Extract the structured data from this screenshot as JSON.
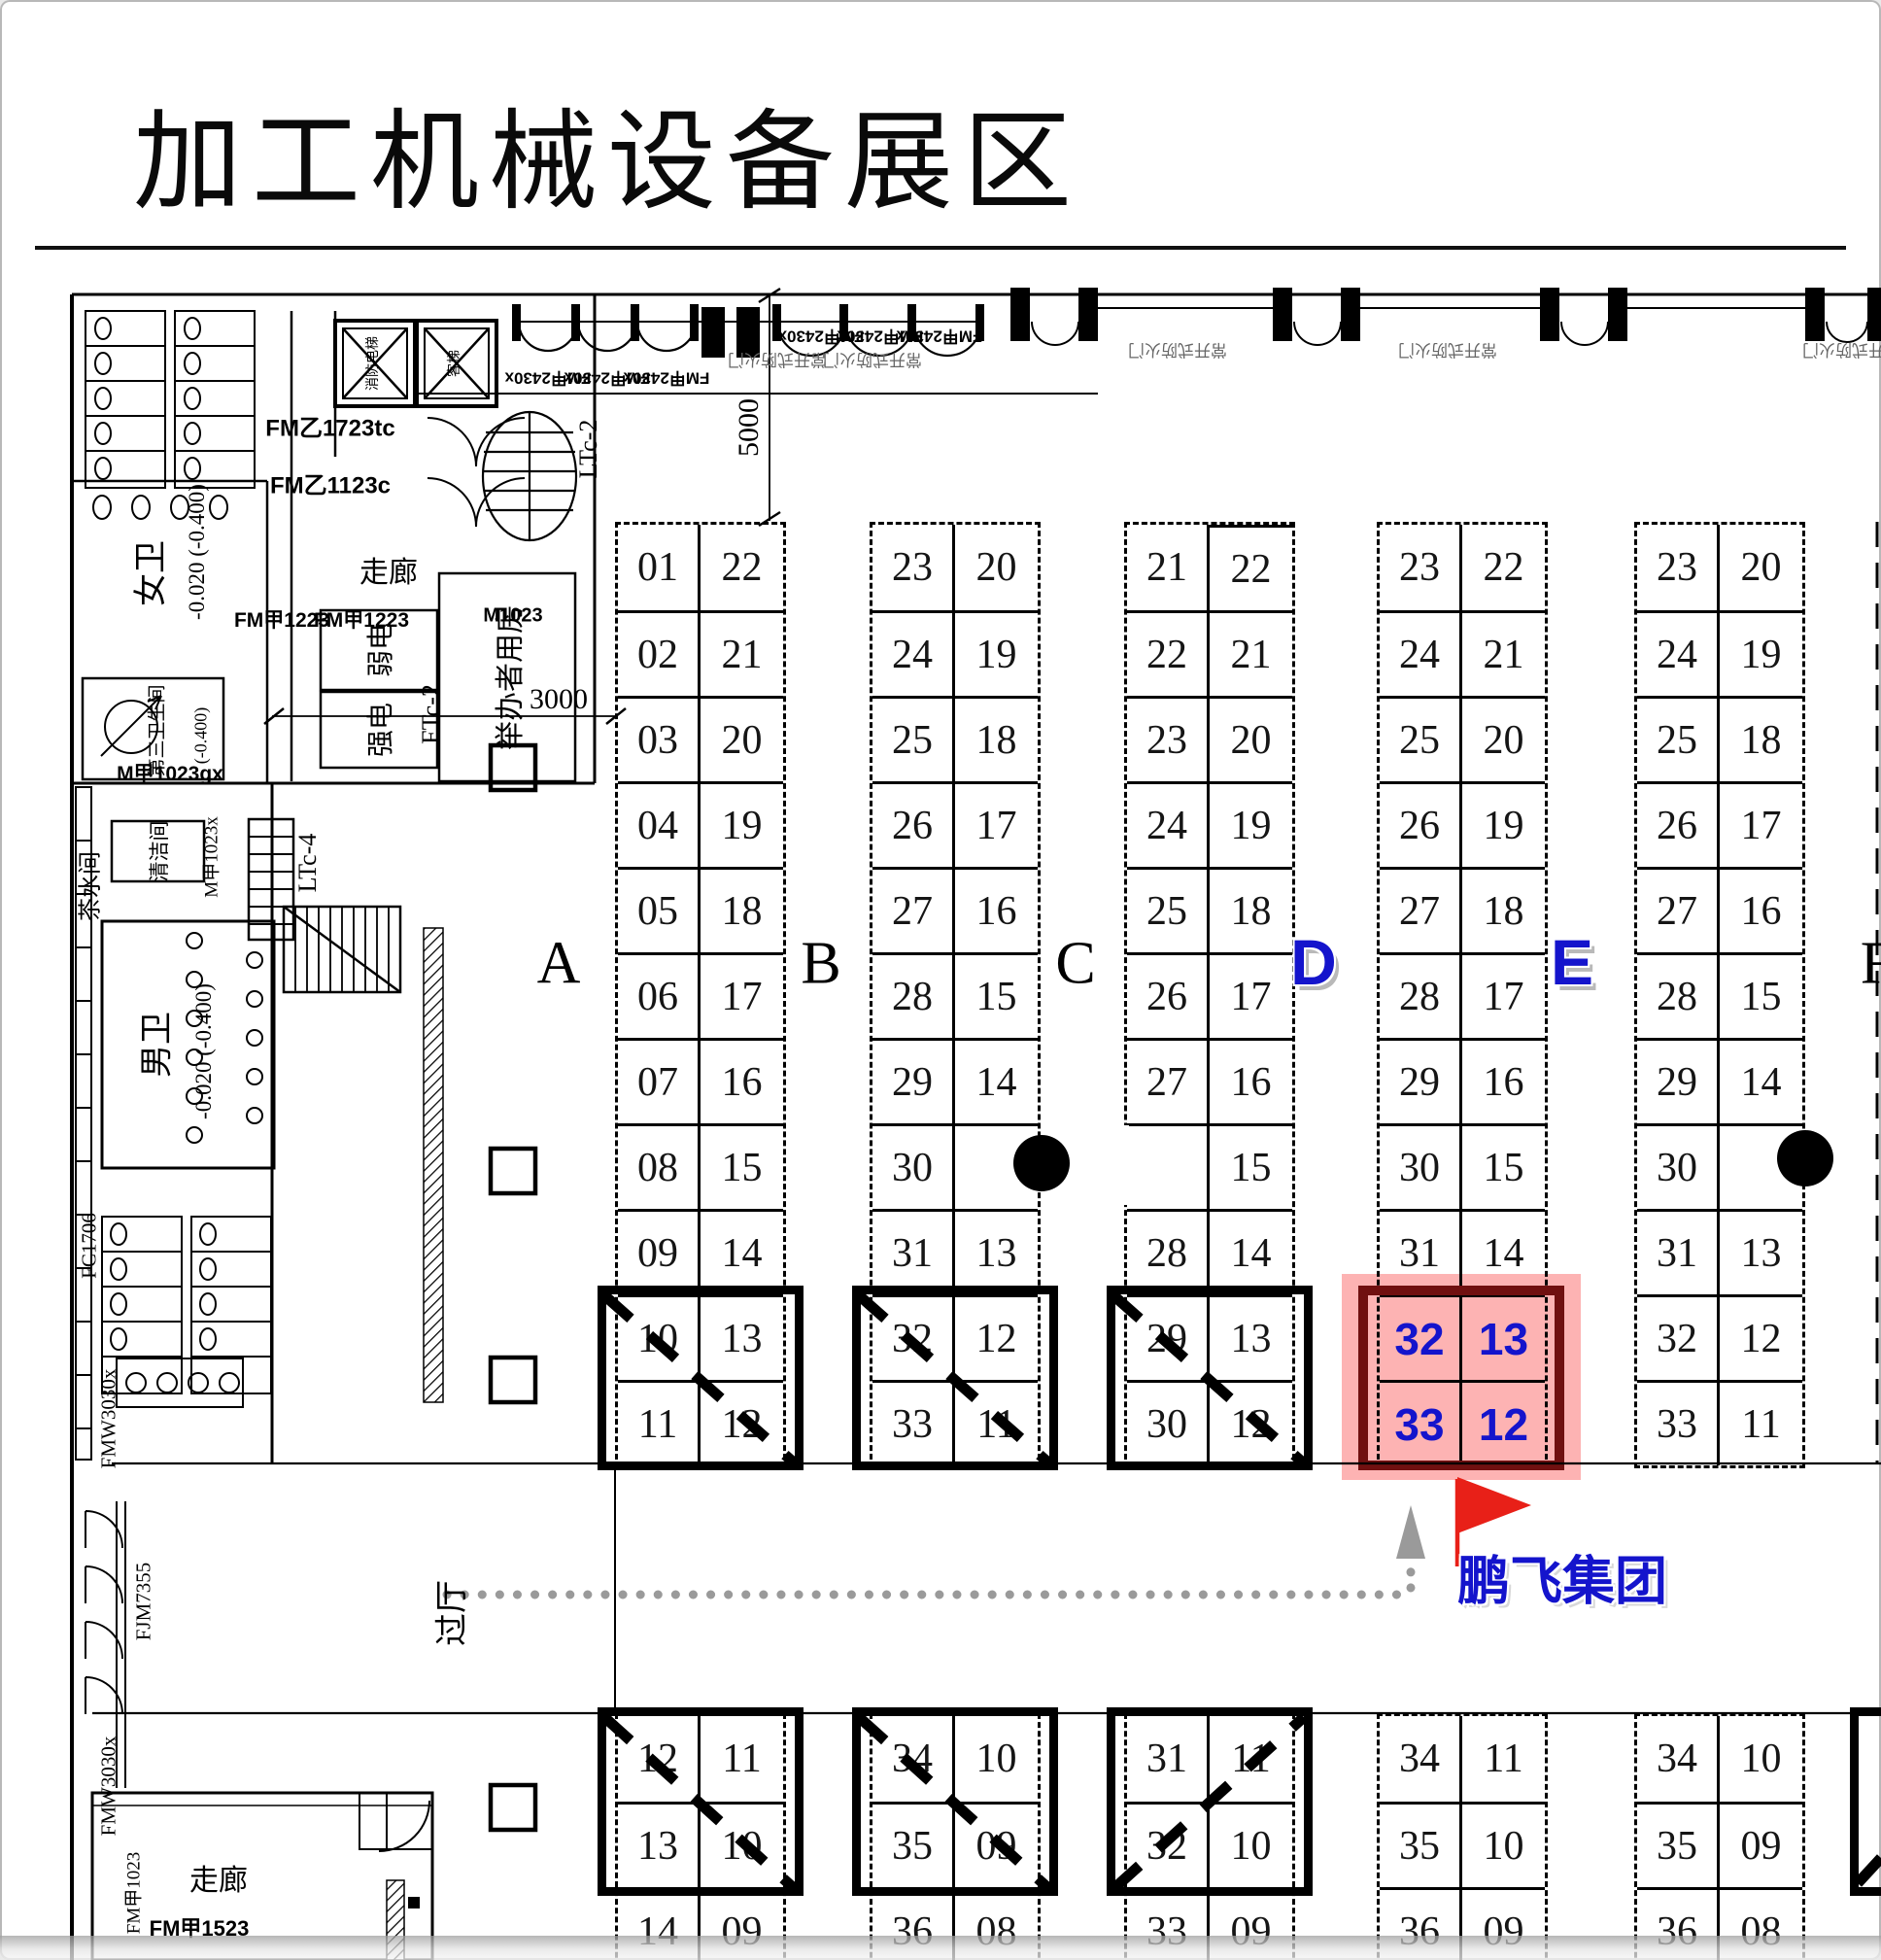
{
  "title": "加工机械设备展区",
  "zones": {
    "a": "A",
    "b": "B",
    "c": "C",
    "d": "D",
    "e": "E",
    "f": "F"
  },
  "dims": {
    "d5000": "5000",
    "d3000": "3000"
  },
  "band": {
    "door_tag": "FM甲2430x",
    "fire_door": "常开式防火门"
  },
  "marker": {
    "company": "鹏飞集团"
  },
  "colors": {
    "highlight_fill": "#fa6060",
    "highlight_border": "#701010",
    "accent_blue": "#1414cc",
    "flag_red": "#e82018",
    "route_gray": "#9a9a9a"
  },
  "plan": {
    "women_wc": "女卫",
    "women_level": "-0.020 (-0.400)",
    "third_wc": "第三卫生间",
    "third_level": "(-0.400)",
    "men_wc": "男卫",
    "men_level": "-0.020 (-0.400)",
    "corridor_mid": "走廊",
    "corridor_bottom": "走廊",
    "weak_electric": "弱电",
    "strong_electric": "强电",
    "organizer_room": "举办者用房",
    "tea_room": "茶水间",
    "cleaning_room": "清洁间",
    "lobby": "过厅",
    "fire_elevator": "消防电梯",
    "passenger_elevator": "客梯",
    "lt2": "LTc-2",
    "lt4": "LTc-4",
    "ft2": "FTc-2",
    "fm1723": "FM乙1723tc",
    "fm1123": "FM乙1123c",
    "fm1223": "FM甲1223",
    "m1023": "M1023",
    "m1023gx": "M甲1023gx",
    "m1023x": "M甲1023x",
    "fm1523": "FM甲1523",
    "fm1023": "FM甲1023",
    "fmw3030": "FMW3030x",
    "fjm7355": "FJM7355",
    "fc1706": "FC1706"
  },
  "blocks_top": [
    {
      "zone": "A",
      "cells": [
        [
          "01",
          "22"
        ],
        [
          "02",
          "21"
        ],
        [
          "03",
          "20"
        ],
        [
          "04",
          "19"
        ],
        [
          "05",
          "18"
        ],
        [
          "06",
          "17"
        ],
        [
          "07",
          "16"
        ],
        [
          "08",
          "15"
        ],
        [
          "09",
          "14"
        ],
        [
          "10",
          "13"
        ],
        [
          "11",
          "12"
        ]
      ]
    },
    {
      "zone": "B",
      "cells": [
        [
          "23",
          "20"
        ],
        [
          "24",
          "19"
        ],
        [
          "25",
          "18"
        ],
        [
          "26",
          "17"
        ],
        [
          "27",
          "16"
        ],
        [
          "28",
          "15"
        ],
        [
          "29",
          "14"
        ],
        [
          "30",
          ""
        ],
        [
          "31",
          "13"
        ],
        [
          "32",
          "12"
        ],
        [
          "33",
          "11"
        ]
      ]
    },
    {
      "zone": "C",
      "cells": [
        [
          "21",
          "22"
        ],
        [
          "22",
          "21"
        ],
        [
          "23",
          "20"
        ],
        [
          "24",
          "19"
        ],
        [
          "25",
          "18"
        ],
        [
          "26",
          "17"
        ],
        [
          "27",
          "16"
        ],
        [
          "",
          "15"
        ],
        [
          "28",
          "14"
        ],
        [
          "29",
          "13"
        ],
        [
          "30",
          "12"
        ]
      ]
    },
    {
      "zone": "D",
      "cells": [
        [
          "23",
          "22"
        ],
        [
          "24",
          "21"
        ],
        [
          "25",
          "20"
        ],
        [
          "26",
          "19"
        ],
        [
          "27",
          "18"
        ],
        [
          "28",
          "17"
        ],
        [
          "29",
          "16"
        ],
        [
          "30",
          "15"
        ],
        [
          "31",
          "14"
        ],
        [
          "32",
          "13"
        ],
        [
          "33",
          "12"
        ]
      ]
    },
    {
      "zone": "E",
      "cells": [
        [
          "23",
          "20"
        ],
        [
          "24",
          "19"
        ],
        [
          "25",
          "18"
        ],
        [
          "26",
          "17"
        ],
        [
          "27",
          "16"
        ],
        [
          "28",
          "15"
        ],
        [
          "29",
          "14"
        ],
        [
          "30",
          ""
        ],
        [
          "31",
          "13"
        ],
        [
          "32",
          "12"
        ],
        [
          "33",
          "11"
        ]
      ]
    }
  ],
  "blocks_bottom": [
    {
      "zone": "A",
      "cells": [
        [
          "12",
          "11"
        ],
        [
          "13",
          "10"
        ],
        [
          "14",
          "09"
        ]
      ]
    },
    {
      "zone": "B",
      "cells": [
        [
          "34",
          "10"
        ],
        [
          "35",
          "09"
        ],
        [
          "36",
          "08"
        ]
      ]
    },
    {
      "zone": "C",
      "cells": [
        [
          "31",
          "11"
        ],
        [
          "32",
          "10"
        ],
        [
          "33",
          "09"
        ]
      ]
    },
    {
      "zone": "D",
      "cells": [
        [
          "34",
          "11"
        ],
        [
          "35",
          "10"
        ],
        [
          "36",
          "09"
        ]
      ]
    },
    {
      "zone": "E",
      "cells": [
        [
          "34",
          "10"
        ],
        [
          "35",
          "09"
        ],
        [
          "36",
          "08"
        ]
      ]
    }
  ]
}
